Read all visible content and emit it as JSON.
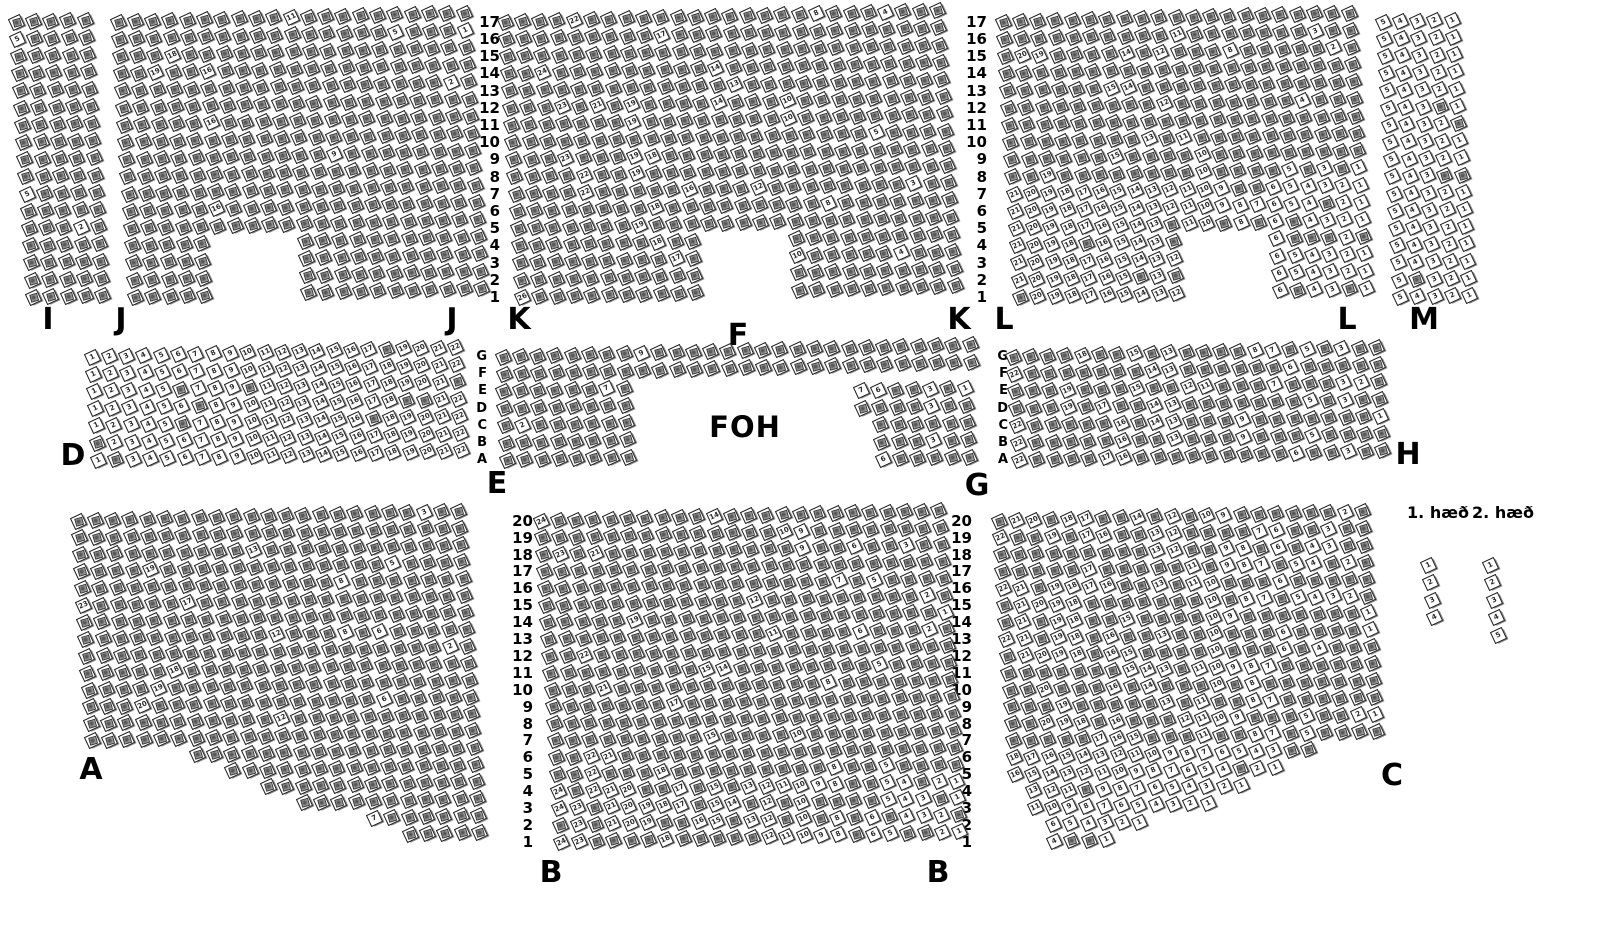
{
  "foh": "FOH",
  "legend": {
    "floor1_label": "1. hæð",
    "floor2_label": "2. hæð",
    "floor1_pos": {
      "x": 1438,
      "y": 503
    },
    "floor2_pos": {
      "x": 1503,
      "y": 503
    }
  },
  "section_labels": [
    {
      "text": "I",
      "x": 48,
      "y": 302
    },
    {
      "text": "J",
      "x": 121,
      "y": 302
    },
    {
      "text": "J",
      "x": 452,
      "y": 302
    },
    {
      "text": "K",
      "x": 519,
      "y": 302
    },
    {
      "text": "K",
      "x": 959,
      "y": 302
    },
    {
      "text": "L",
      "x": 1004,
      "y": 302
    },
    {
      "text": "L",
      "x": 1347,
      "y": 302
    },
    {
      "text": "M",
      "x": 1424,
      "y": 302
    },
    {
      "text": "F",
      "x": 738,
      "y": 318
    },
    {
      "text": "D",
      "x": 73,
      "y": 438
    },
    {
      "text": "E",
      "x": 497,
      "y": 466
    },
    {
      "text": "G",
      "x": 977,
      "y": 468
    },
    {
      "text": "H",
      "x": 1408,
      "y": 437
    },
    {
      "text": "A",
      "x": 91,
      "y": 752
    },
    {
      "text": "B",
      "x": 551,
      "y": 855
    },
    {
      "text": "B",
      "x": 938,
      "y": 855
    },
    {
      "text": "C",
      "x": 1392,
      "y": 758
    }
  ],
  "foh_pos": {
    "x": 745,
    "y": 410
  },
  "axes": [
    {
      "name": "rows-top-left",
      "values": [
        "17",
        "16",
        "15",
        "14",
        "13",
        "12",
        "11",
        "10",
        "9",
        "8",
        "7",
        "6",
        "5",
        "4",
        "3",
        "2",
        "1"
      ],
      "x": 500,
      "y0": 22,
      "dy": 17.2,
      "size": 15
    },
    {
      "name": "rows-top-right",
      "values": [
        "17",
        "16",
        "15",
        "14",
        "13",
        "12",
        "11",
        "10",
        "9",
        "8",
        "7",
        "6",
        "5",
        "4",
        "3",
        "2",
        "1"
      ],
      "x": 987,
      "y0": 22,
      "dy": 17.2,
      "size": 15
    },
    {
      "name": "rows-middle-left",
      "values": [
        "G",
        "F",
        "E",
        "D",
        "C",
        "B",
        "A"
      ],
      "x": 487,
      "y0": 357,
      "dy": 17.2,
      "size": 13
    },
    {
      "name": "rows-middle-right",
      "values": [
        "G",
        "F",
        "E",
        "D",
        "C",
        "B",
        "A"
      ],
      "x": 1008,
      "y0": 357,
      "dy": 17.2,
      "size": 13
    },
    {
      "name": "rows-bottom-left",
      "values": [
        "20",
        "19",
        "18",
        "17",
        "16",
        "15",
        "14",
        "13",
        "12",
        "11",
        "10",
        "9",
        "8",
        "7",
        "6",
        "5",
        "4",
        "3",
        "2",
        "1"
      ],
      "x": 533,
      "y0": 521,
      "dy": 16.9,
      "size": 15
    },
    {
      "name": "rows-bottom-right",
      "values": [
        "20",
        "19",
        "18",
        "17",
        "16",
        "15",
        "14",
        "13",
        "12",
        "11",
        "10",
        "9",
        "8",
        "7",
        "6",
        "5",
        "4",
        "3",
        "2",
        "1"
      ],
      "x": 972,
      "y0": 521,
      "dy": 16.9,
      "size": 15
    }
  ],
  "seat_style": {
    "outline_color": "#1c1c1c",
    "occupied_fill": "#8f8f8f",
    "free_fill": "#ffffff",
    "rotation_deg": -25,
    "pitch_x": 17.3,
    "row_shear": 1.1,
    "col_rise": 0.45
  },
  "sections": [
    {
      "name": "I",
      "x": 16,
      "y": 22,
      "cols": 5,
      "rows": 17,
      "dy": 17.2,
      "free": 0.03,
      "dir": "rl"
    },
    {
      "name": "J",
      "x": 118,
      "y": 22,
      "cols": 21,
      "rows": 17,
      "dy": 17.2,
      "free": 0.04,
      "dir": "rl",
      "notch": {
        "r0": 13,
        "r1": 16,
        "c0": 5,
        "c1": 9
      }
    },
    {
      "name": "K",
      "x": 505,
      "y": 22,
      "cols": 26,
      "rows": 17,
      "dy": 17.2,
      "free": 0.06,
      "dir": "rl",
      "notch": {
        "r0": 13,
        "r1": 16,
        "c0": 11,
        "c1": 15
      }
    },
    {
      "name": "L",
      "x": 1003,
      "y": 22,
      "cols": 21,
      "rows": 17,
      "dy": 17.2,
      "free": 0.1,
      "dir": "rl",
      "notch": {
        "r0": 13,
        "r1": 16,
        "c0": 10,
        "c1": 14
      },
      "fb": 7,
      "fbr": 0.85
    },
    {
      "name": "M",
      "x": 1383,
      "y": 22,
      "cols": 5,
      "rows": 17,
      "dy": 17.2,
      "free": 0.95,
      "dir": "rl"
    },
    {
      "name": "D",
      "x": 92,
      "y": 357,
      "cols": 22,
      "rows": 7,
      "dy": 17.2,
      "free": 0.92,
      "dir": "lr"
    },
    {
      "name": "F",
      "x": 503,
      "y": 357,
      "cols": 28,
      "rows": 2,
      "dy": 17.2,
      "free": 0.07,
      "dir": "lr"
    },
    {
      "name": "E",
      "x": 503,
      "y": 391.4,
      "cols": 8,
      "rows": 5,
      "dy": 17.2,
      "free": 0.07,
      "dir": "lr"
    },
    {
      "name": "G",
      "x": 844,
      "y": 391.4,
      "cols": 8,
      "rows": 5,
      "dy": 17.2,
      "free": 0.2,
      "dir": "rl",
      "ranges": {
        "0": [
          1,
          7
        ],
        "1": [
          1,
          7
        ],
        "2": [
          2,
          7
        ],
        "3": [
          2,
          7
        ],
        "4": [
          2,
          7
        ]
      }
    },
    {
      "name": "H",
      "x": 1013,
      "y": 357,
      "cols": 22,
      "rows": 7,
      "dy": 17.2,
      "free": 0.25,
      "dir": "rl"
    },
    {
      "name": "A",
      "x": 78,
      "y": 521,
      "cols": 23,
      "rows": 20,
      "dy": 16.9,
      "free": 0.04,
      "dir": "rl",
      "ranges": {
        "14": [
          6,
          22
        ],
        "15": [
          8,
          22
        ],
        "16": [
          10,
          22
        ],
        "17": [
          12,
          22
        ],
        "18": [
          16,
          22
        ],
        "19": [
          18,
          22
        ]
      }
    },
    {
      "name": "B",
      "x": 541,
      "y": 521,
      "cols": 24,
      "rows": 20,
      "dy": 16.9,
      "free": 0.08,
      "dir": "rl",
      "fb": 4,
      "fbr": 0.5
    },
    {
      "name": "C",
      "x": 999,
      "y": 521,
      "cols": 22,
      "rows": 20,
      "dy": 16.9,
      "free": 0.35,
      "dir": "rl",
      "ranges": {
        "14": [
          0,
          17
        ],
        "15": [
          0,
          15
        ],
        "16": [
          1,
          13
        ],
        "17": [
          1,
          11
        ],
        "18": [
          2,
          7
        ],
        "19": [
          2,
          5
        ]
      },
      "fb": 6,
      "fbr": 0.9
    },
    {
      "name": "floor1-seats",
      "x": 1428,
      "y": 565,
      "cols": 1,
      "rows": 4,
      "dy": 17.5,
      "free": 1,
      "dir": "tb",
      "shear": 2
    },
    {
      "name": "floor2-seats",
      "x": 1490,
      "y": 565,
      "cols": 1,
      "rows": 5,
      "dy": 17.5,
      "free": 1,
      "dir": "tb",
      "shear": 2
    }
  ]
}
